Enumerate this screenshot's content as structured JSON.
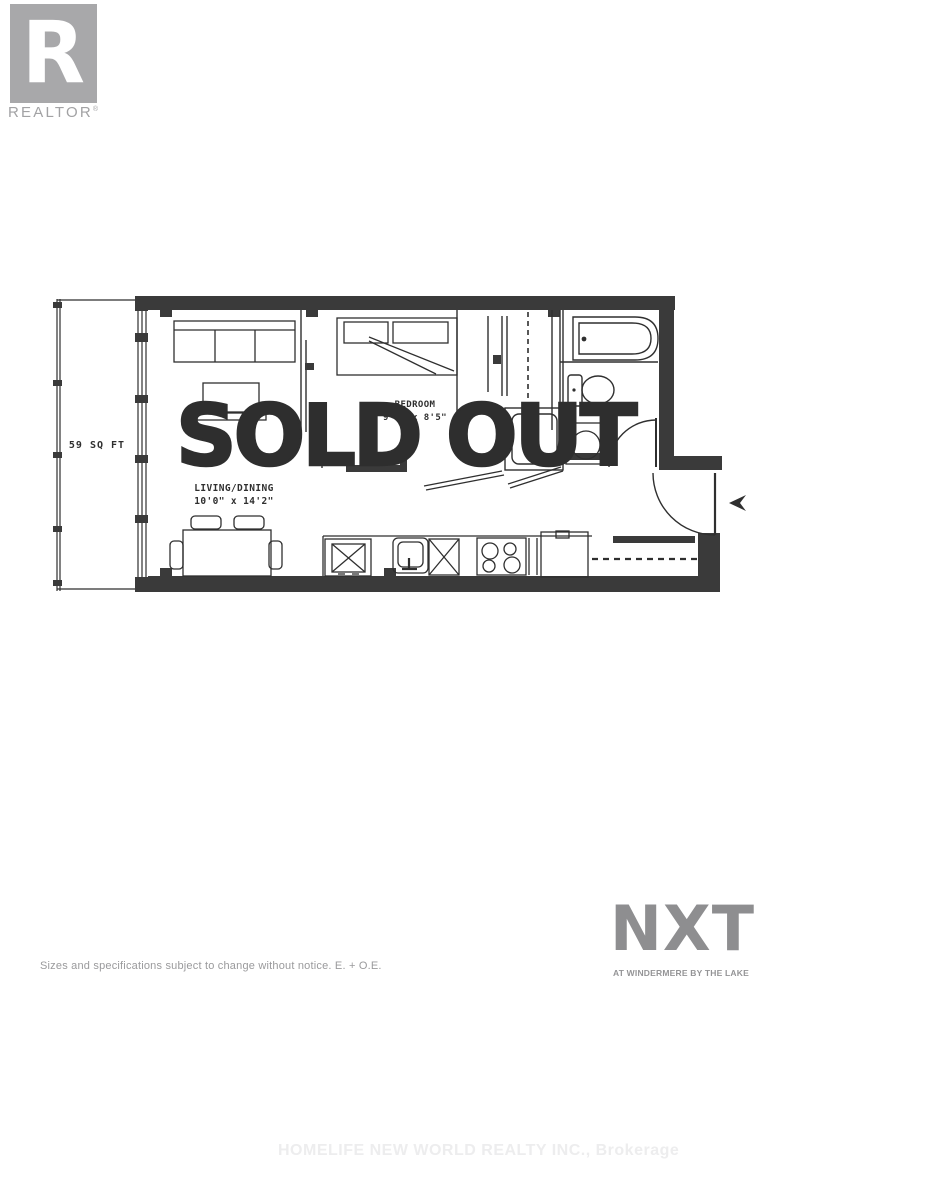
{
  "branding": {
    "realtor_logo": {
      "letter": "R",
      "wordmark": "REALTOR",
      "registered": "®"
    },
    "nxt": {
      "name": "NXT",
      "tagline": "AT WINDERMERE BY THE LAKE"
    }
  },
  "floor_plan": {
    "balcony_label": "59 SQ FT",
    "rooms": [
      {
        "name": "LIVING/DINING",
        "dimensions": "10'0\" x 14'2\""
      },
      {
        "name": "BEDROOM",
        "dimensions": "9'4\" x 8'5\""
      }
    ]
  },
  "overlay": {
    "status": "SOLD OUT"
  },
  "footer": {
    "disclaimer": "Sizes and specifications subject to change without notice. E. + O.E.",
    "brokerage": "HOMELIFE NEW WORLD REALTY INC., Brokerage"
  },
  "colors": {
    "wall": "#3a3a3a",
    "line": "#2f2f2f",
    "sold_out": "#2e2e2e",
    "brand_gray": "#a8a8aa",
    "nxt_gray": "#8e8e90",
    "watermark": "#ededee"
  }
}
